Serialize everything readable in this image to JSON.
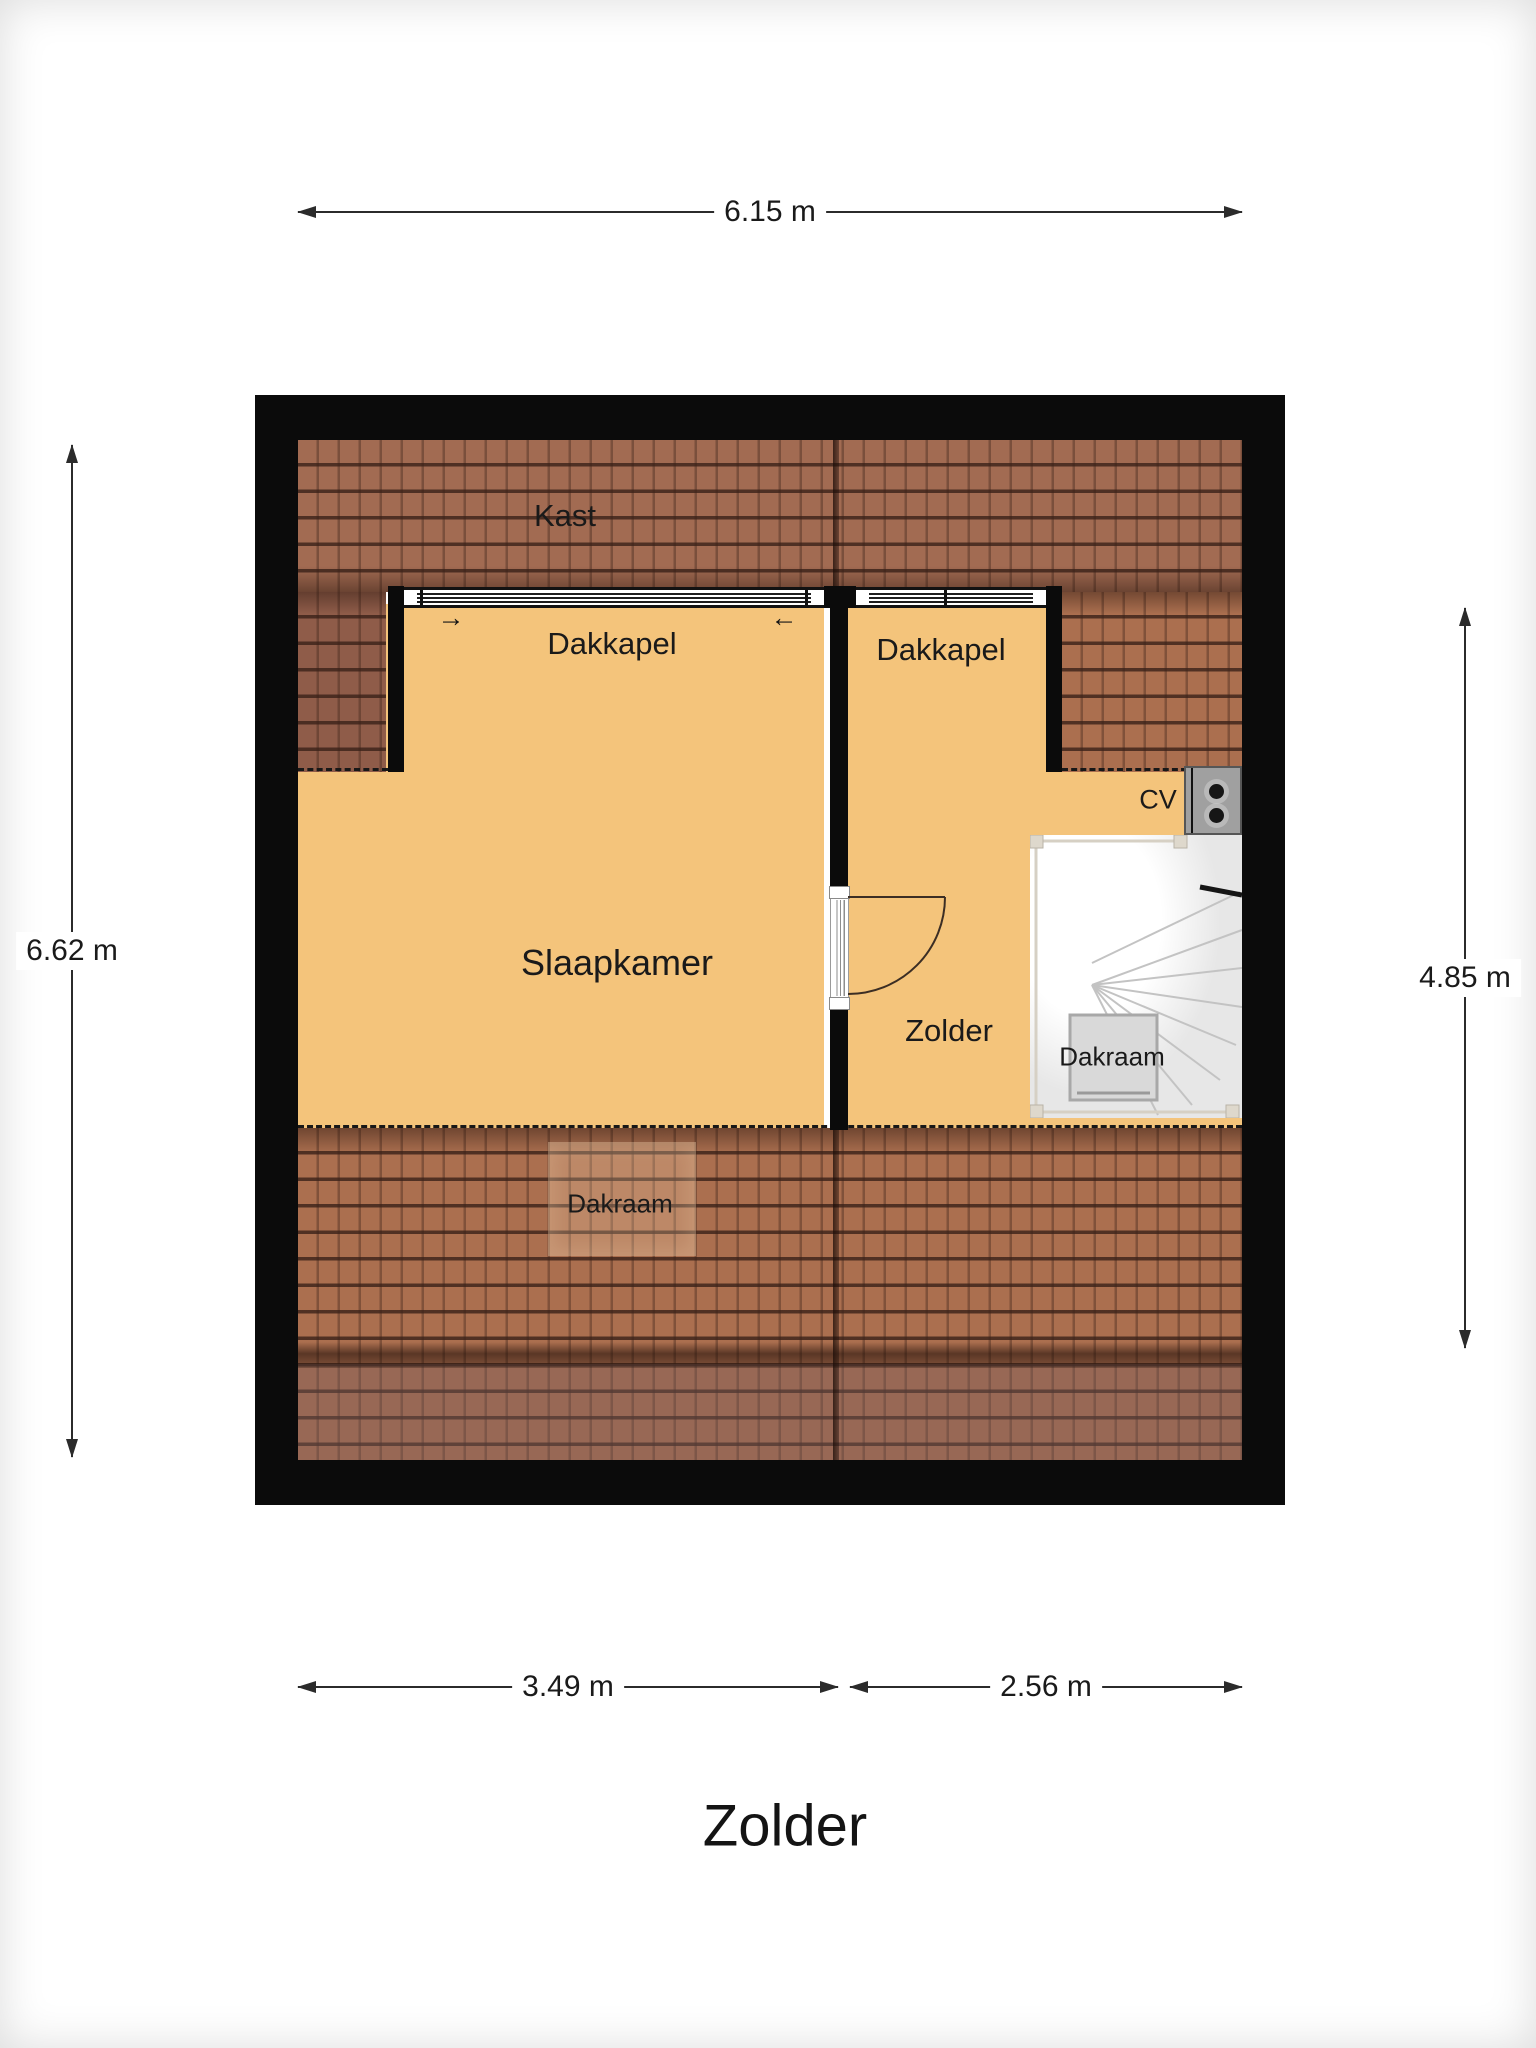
{
  "page_title": "Zolder",
  "dimensions": {
    "width_total": "6.15 m",
    "height_total": "6.62 m",
    "height_right": "4.85 m",
    "width_slaapkamer": "3.49 m",
    "width_zolder": "2.56 m"
  },
  "labels": {
    "kast": "Kast",
    "dakkapel_left": "Dakkapel",
    "dakkapel_right": "Dakkapel",
    "slaapkamer": "Slaapkamer",
    "zolder_room": "Zolder",
    "dakraam_stairs": "Dakraam",
    "dakraam_roof": "Dakraam",
    "cv": "CV"
  },
  "icons": {
    "window_arrow_right": "→",
    "window_arrow_left": "←"
  },
  "colors": {
    "wall": "#0b0b0b",
    "floor": "#f4c47b",
    "roof_top_band": "#a26b52",
    "roof_left_column": "#8f5c49",
    "roof_right_slope": "#ab6f4f",
    "roof_bottom_upper": "#ab6f4f",
    "roof_bottom_lower": "#9d6b54",
    "roof_dark_band": "#53372c",
    "stairs_bg": "#e9e9e9",
    "cv_unit": "#a0a0a0",
    "dimension_text": "#1a1a1a"
  }
}
